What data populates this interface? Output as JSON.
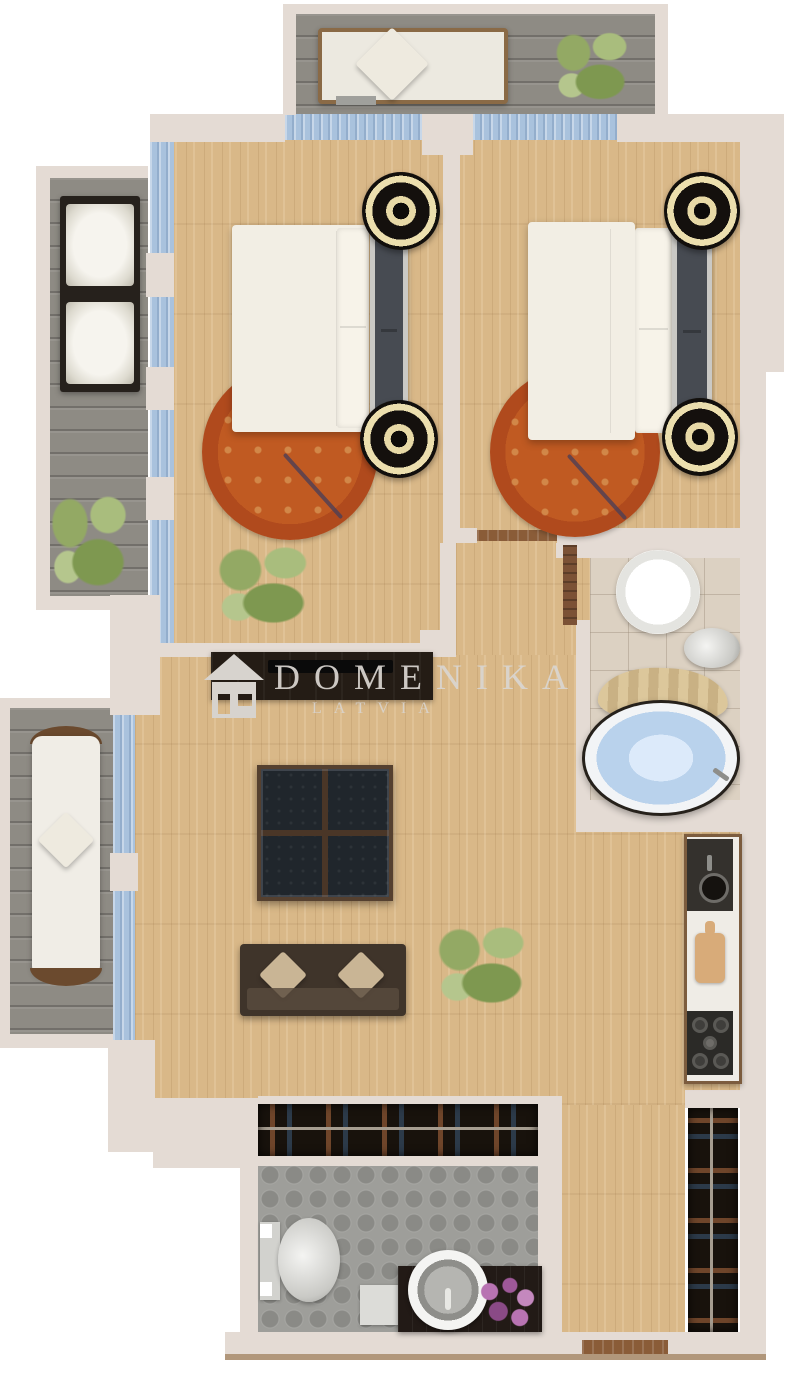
{
  "watermark": {
    "brand": "DOMENIKA",
    "country": "LATVIA",
    "icon": "house-icon"
  },
  "palette": {
    "wall": "#e4dbd4",
    "wood_floor": "#d9b888",
    "window_glass": "#a9c2dd",
    "balcony_deck": "#8e8b84",
    "rug_red": "#b9501f",
    "rug_gold": "#cda765",
    "bathroom_tile": "#dcd1c2",
    "lower_bath_tile": "#9e9e9a",
    "tub_water": "#b9d2ec",
    "dark_furniture": "#18120c",
    "door_wood": "#7b5135",
    "flowers_purple": "#b873b2"
  },
  "rooms": [
    {
      "id": "balcony-top",
      "label": "balcony"
    },
    {
      "id": "bedroom-left",
      "label": "bedroom"
    },
    {
      "id": "bedroom-right",
      "label": "bedroom"
    },
    {
      "id": "balcony-left-upper",
      "label": "balcony"
    },
    {
      "id": "bathroom-upper",
      "label": "bathroom"
    },
    {
      "id": "living-room",
      "label": "living-room"
    },
    {
      "id": "balcony-left-lower",
      "label": "balcony"
    },
    {
      "id": "kitchen",
      "label": "kitchen"
    },
    {
      "id": "hallway",
      "label": "hallway"
    },
    {
      "id": "bathroom-lower",
      "label": "bathroom"
    },
    {
      "id": "wardrobe",
      "label": "wardrobe"
    }
  ],
  "furniture_icons": [
    "bench-icon",
    "plant-icon",
    "outdoor-sofa-icon",
    "double-bed-icon",
    "nightstand-icon",
    "round-rug-icon",
    "wash-basin-icon",
    "toilet-icon",
    "shower-curtain-icon",
    "round-tub-icon",
    "tv-console-icon",
    "tv-icon",
    "coffee-table-icon",
    "sofa-icon",
    "lounge-chair-icon",
    "kitchen-sink-icon",
    "cutting-board-icon",
    "cooktop-icon",
    "closet-rail-icon",
    "vanity-sink-icon",
    "flowers-icon",
    "door-icon",
    "entry-threshold-icon"
  ]
}
